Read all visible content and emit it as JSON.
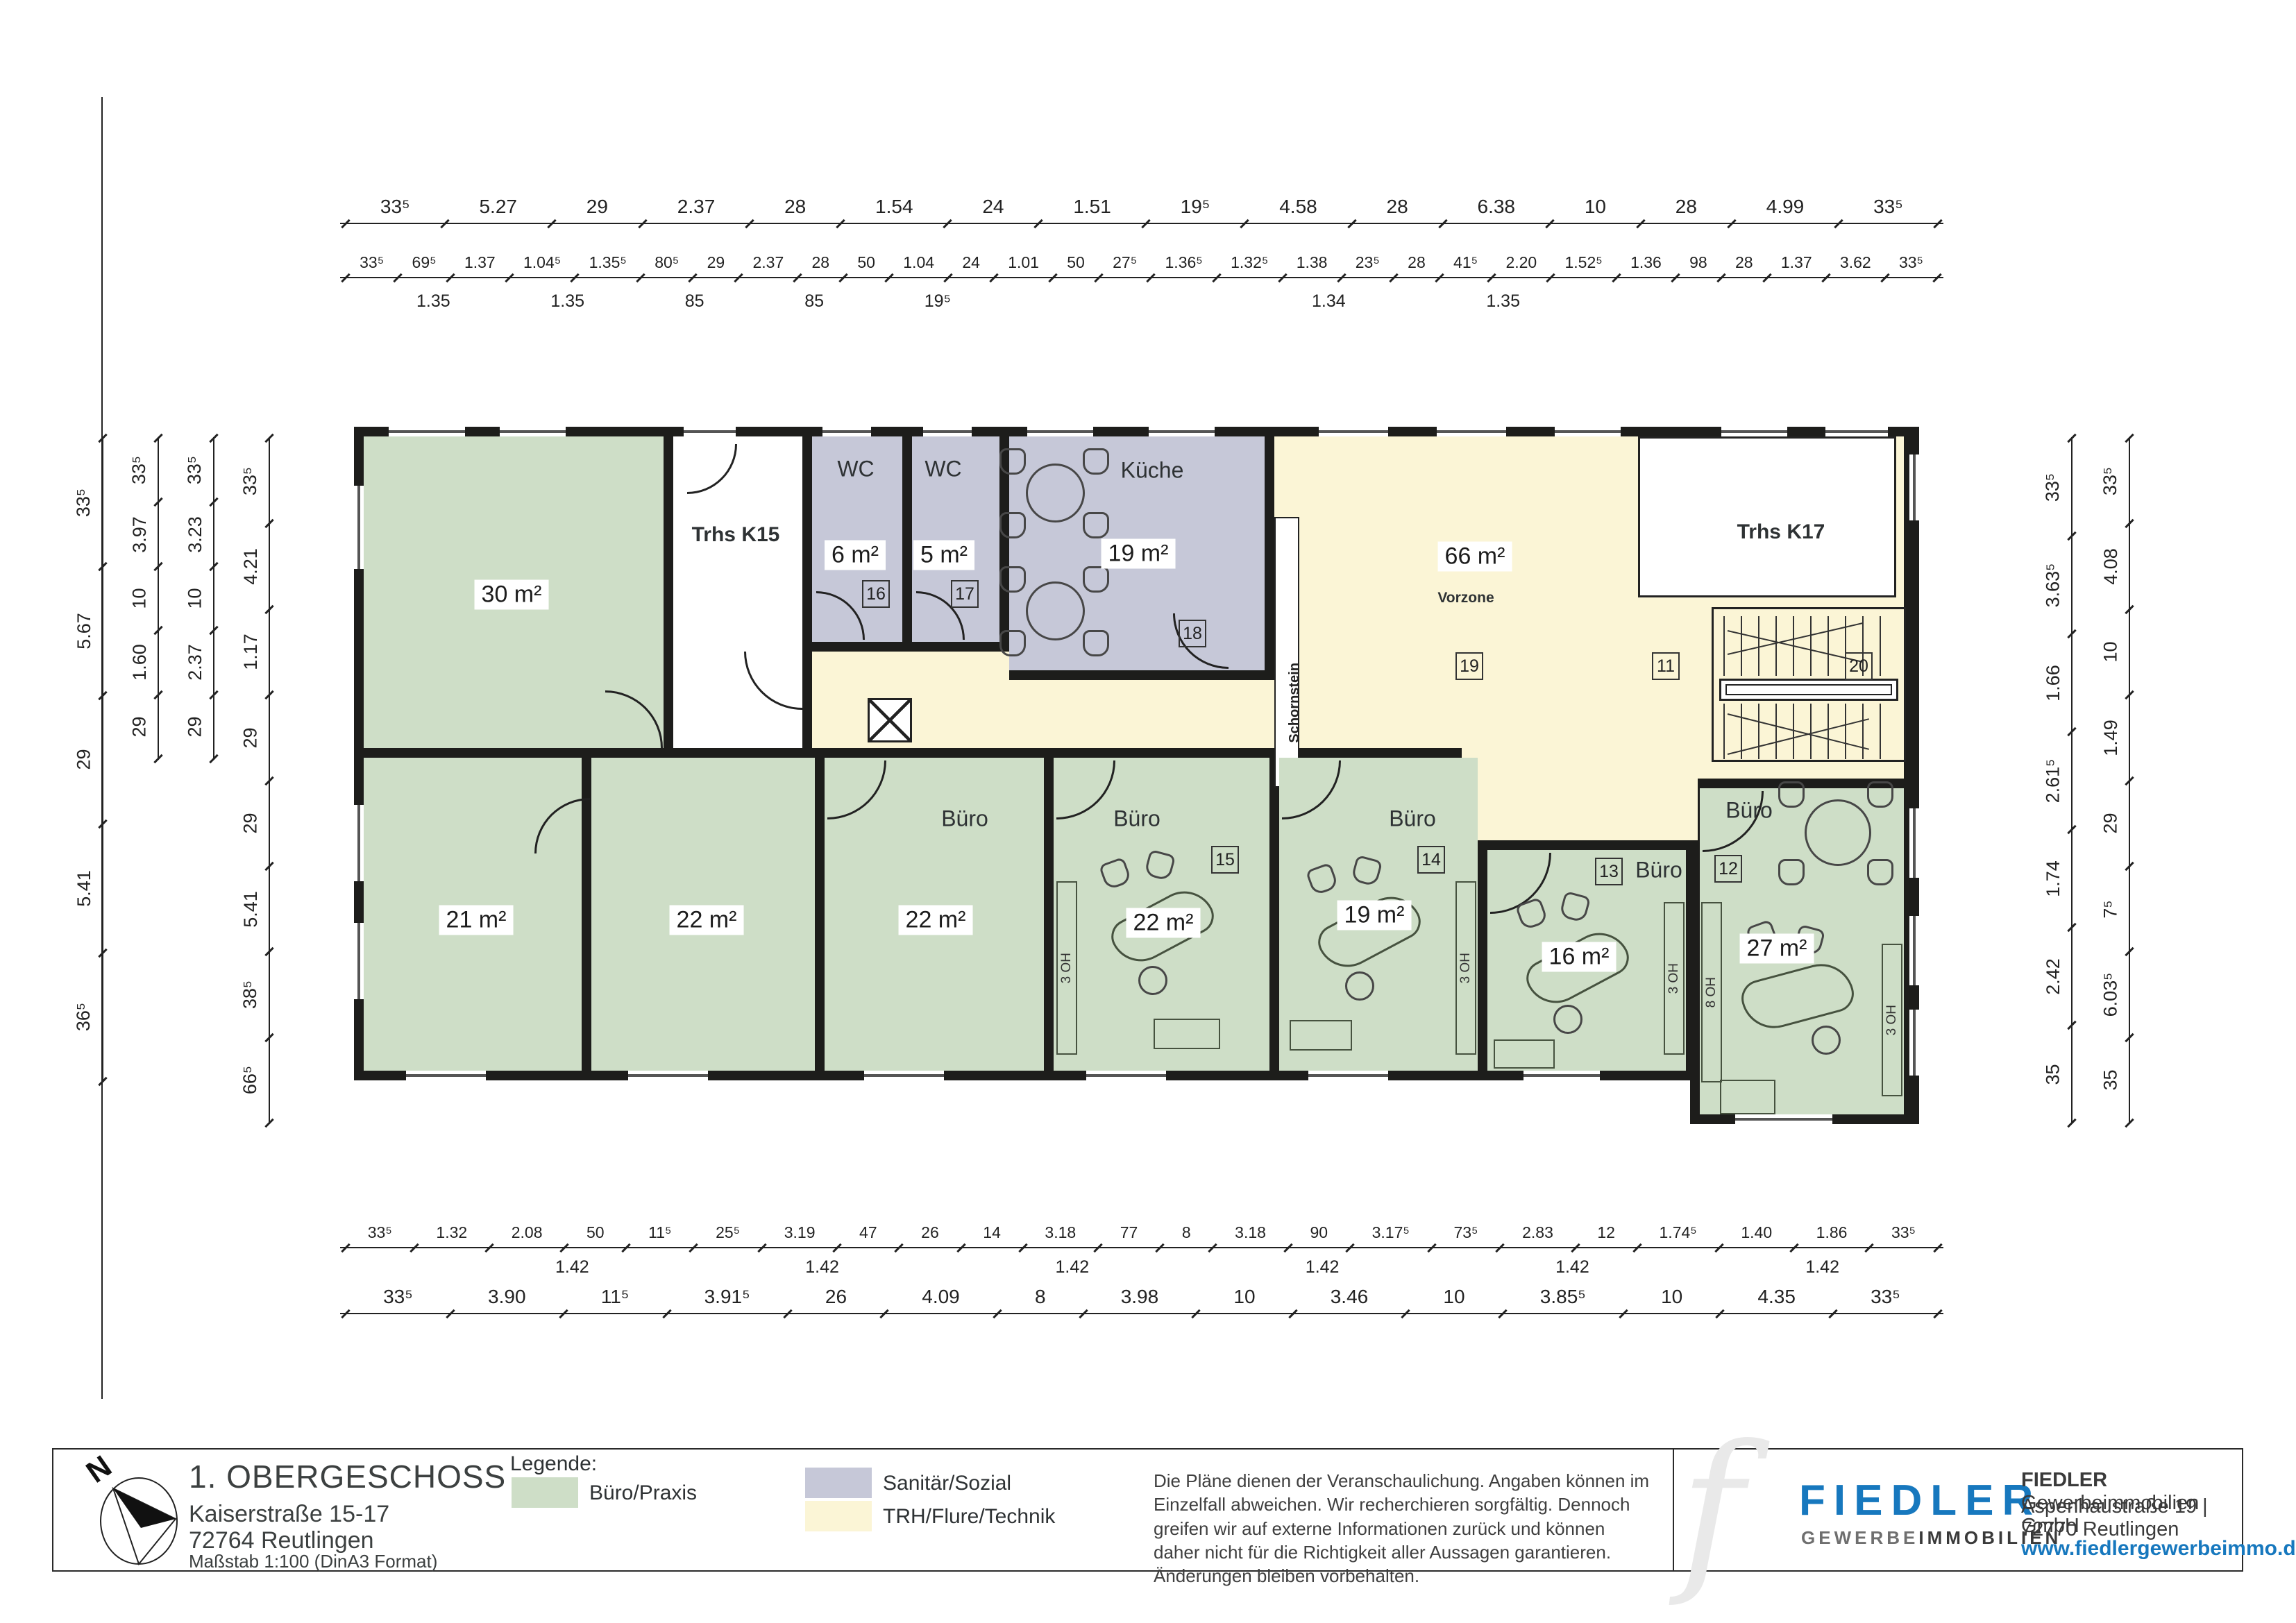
{
  "colors": {
    "office_green": "#cedec7",
    "sanitary_purple": "#c6c8d8",
    "circulation_yellow": "#fbf5d6",
    "wall": "#1d1d1b",
    "brand_blue": "#1778be"
  },
  "plan": {
    "rooms": {
      "r30": {
        "area": "30 m²"
      },
      "trhs_k15": {
        "label": "Trhs K15"
      },
      "wc1": {
        "name": "WC",
        "area": "6 m²",
        "num": "16"
      },
      "wc2": {
        "name": "WC",
        "area": "5 m²",
        "num": "17"
      },
      "kueche": {
        "name": "Küche",
        "area": "19 m²",
        "num": "18"
      },
      "schornstein": {
        "label": "Schornstein"
      },
      "vorzone": {
        "name": "Vorzone",
        "area": "66 m²",
        "num": "19"
      },
      "trhs_k17": {
        "label": "Trhs K17"
      },
      "stair": {
        "num_left": "11",
        "num_right": "20"
      },
      "b1": {
        "area": "21 m²"
      },
      "b2": {
        "area": "22 m²"
      },
      "b3": {
        "name": "Büro",
        "area": "22 m²"
      },
      "b4": {
        "name": "Büro",
        "area": "22 m²",
        "num": "15"
      },
      "b5": {
        "name": "Büro",
        "area": "19 m²",
        "num": "14"
      },
      "b6": {
        "name": "Büro",
        "area": "16 m²",
        "num": "13"
      },
      "b7": {
        "name": "Büro",
        "area": "27 m²",
        "num": "12"
      },
      "cabinet_3oh": "3 OH",
      "cabinet_8oh": "8 OH"
    }
  },
  "dims": {
    "top_row1": [
      "33⁵",
      "5.27",
      "29",
      "2.37",
      "28",
      "1.54",
      "24",
      "1.51",
      "19⁵",
      "4.58",
      "28",
      "6.38",
      "10",
      "28",
      "4.99",
      "33⁵"
    ],
    "top_row2": [
      "33⁵",
      "69⁵",
      "1.37",
      "1.04⁵",
      "1.35⁵",
      "80⁵",
      "29",
      "2.37",
      "28",
      "50",
      "1.04",
      "24",
      "1.01",
      "50",
      "27⁵",
      "1.36⁵",
      "1.32⁵",
      "1.38",
      "23⁵",
      "28",
      "41⁵",
      "2.20",
      "1.52⁵",
      "1.36",
      "98",
      "28",
      "1.37",
      "3.62",
      "33⁵"
    ],
    "top_sub_left": [
      "1.35",
      "1.35",
      "85",
      "85",
      "19⁵"
    ],
    "top_sub_right": [
      "1.34",
      "1.35"
    ],
    "bottom_row1": [
      "33⁵",
      "1.32",
      "2.08",
      "50",
      "11⁵",
      "25⁵",
      "3.19",
      "47",
      "26",
      "14",
      "3.18",
      "77",
      "8",
      "3.18",
      "90",
      "3.17⁵",
      "73⁵",
      "2.83",
      "12",
      "1.74⁵",
      "1.40",
      "1.86",
      "33⁵"
    ],
    "bottom_sub": [
      "1.42",
      "1.42",
      "1.42",
      "1.42",
      "1.42",
      "1.42"
    ],
    "bottom_row2": [
      "33⁵",
      "3.90",
      "11⁵",
      "3.91⁵",
      "26",
      "4.09",
      "8",
      "3.98",
      "10",
      "3.46",
      "10",
      "3.85⁵",
      "10",
      "4.35",
      "33⁵"
    ],
    "left_a": [
      "33⁵",
      "5.67",
      "29",
      "5.41",
      "36⁵"
    ],
    "left_b": [
      "33⁵",
      "3.97",
      "10",
      "1.60",
      "29"
    ],
    "left_c": [
      "33⁵",
      "3.23",
      "10",
      "2.37",
      "29"
    ],
    "left_d": [
      "33⁵",
      "4.21",
      "1.17",
      "29",
      "29",
      "5.41",
      "38⁵",
      "66⁵"
    ],
    "right_inner": [
      "33⁵",
      "3.63⁵",
      "1.66",
      "2.61⁵",
      "1.74",
      "2.42",
      "35"
    ],
    "right_outer": [
      "33⁵",
      "4.08",
      "10",
      "1.49",
      "29",
      "7⁵",
      "6.03⁵",
      "35"
    ]
  },
  "footer": {
    "compass": "N",
    "title": "1. OBERGESCHOSS",
    "address1": "Kaiserstraße 15-17",
    "address2": "72764 Reutlingen",
    "scale": "Maßstab 1:100 (DinA3 Format)",
    "legend_title": "Legende:",
    "legend": [
      {
        "label": "Büro/Praxis",
        "color": "#cedec7"
      },
      {
        "label": "Sanitär/Sozial",
        "color": "#c6c8d8"
      },
      {
        "label": "TRH/Flure/Technik",
        "color": "#fbf5d6"
      }
    ],
    "disclaimer": "Die Pläne dienen der Veranschaulichung. Angaben können im Einzelfall abweichen. Wir recherchieren sorgfältig. Dennoch greifen wir auf externe Informationen zurück und können daher nicht für die Richtigkeit aller Aussagen garantieren. Änderungen bleiben vorbehalten.",
    "brand": "FIEDLER",
    "brand_sub_gray": "GEWERBE",
    "brand_sub_dark": "IMMOBILIEN",
    "brand_f": "f",
    "company_line1_bold": "FIEDLER",
    "company_line1_rest": " Gewerbeimmobilien GmbH",
    "company_line2": "Aspenhaustraße 19 | 72770 Reutlingen",
    "website": "www.fiedlergewerbeimmo.de"
  }
}
